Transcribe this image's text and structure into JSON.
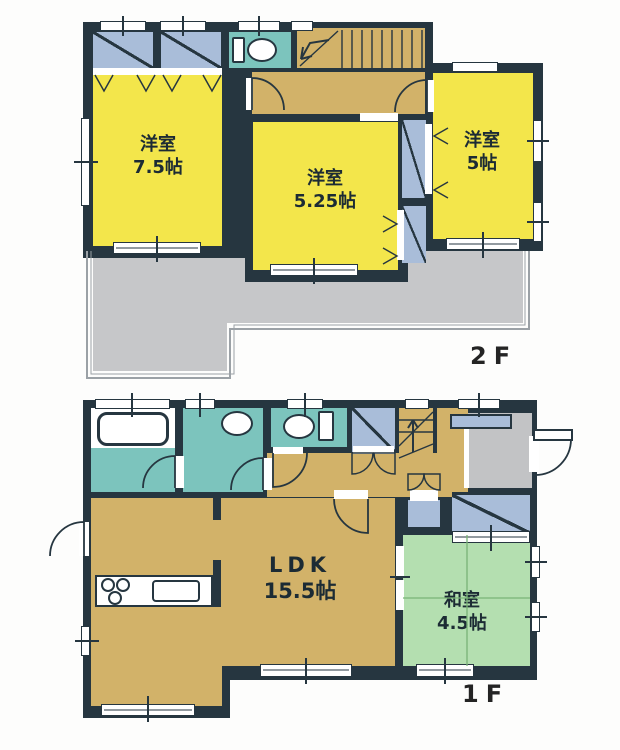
{
  "title": "2-story house floor plan",
  "colors": {
    "wall": "#263640",
    "yellow": "#f3e64b",
    "tan": "#d2b269",
    "teal": "#7cc4bd",
    "blue": "#a9bdd9",
    "green": "#b4dfb0",
    "balcony": "#c6c7c9",
    "entrance": "#c2c3c5",
    "line": "#1c2b34"
  },
  "floors": [
    {
      "label": "2F",
      "rooms": [
        {
          "name": "洋室",
          "size": "7.5帖"
        },
        {
          "name": "洋室",
          "size": "5.25帖"
        },
        {
          "name": "洋室",
          "size": "5帖"
        }
      ],
      "fixtures": [
        "toilet",
        "stairs",
        "closet",
        "closet",
        "balcony"
      ]
    },
    {
      "label": "1F",
      "rooms": [
        {
          "name": "LDK",
          "size": "15.5帖"
        },
        {
          "name": "和室",
          "size": "4.5帖"
        }
      ],
      "fixtures": [
        "bathtub",
        "washbasin",
        "toilet",
        "stairs",
        "kitchen-stove",
        "kitchen-sink",
        "shoe-cabinet",
        "entrance",
        "closet"
      ]
    }
  ]
}
